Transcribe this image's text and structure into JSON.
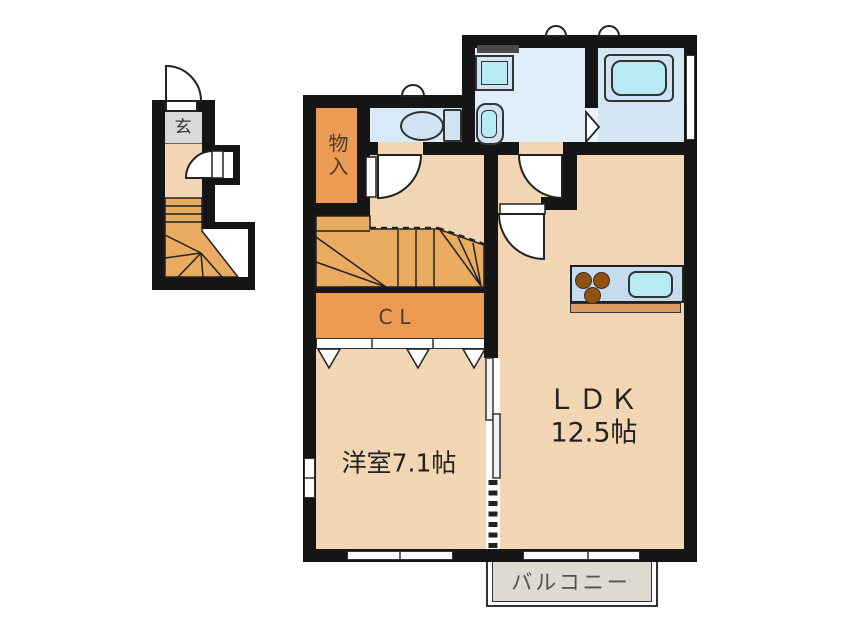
{
  "floor_plan": {
    "rooms": [
      {
        "id": "entrance",
        "label": "玄"
      },
      {
        "id": "storage",
        "label": "物入"
      },
      {
        "id": "closet",
        "label": "CL"
      },
      {
        "id": "western_room",
        "label": "洋室7.1帖"
      },
      {
        "id": "ldk",
        "label_line1": "ＬＤＫ",
        "label_line2": "12.5帖"
      },
      {
        "id": "balcony",
        "label": "バルコニー"
      }
    ],
    "colors": {
      "wall": "#151515",
      "floor": "#f2d5b3",
      "stairs": "#e9ab60",
      "closet_orange": "#ec9b55",
      "wet_blue_wash": "#dfeefa",
      "wet_blue_toilet": "#d8e9f7",
      "wet_blue_bath": "#d3e6f3",
      "fixture_blue": "#cfe3f2",
      "fixture_cyan": "#b7eaf3",
      "tile_gray": "#d9d9d9",
      "balcony_fill": "#dedacf",
      "counter_blue": "#c7dbef",
      "burner_brown": "#94500f",
      "counter_edge": "#db9d62"
    }
  }
}
